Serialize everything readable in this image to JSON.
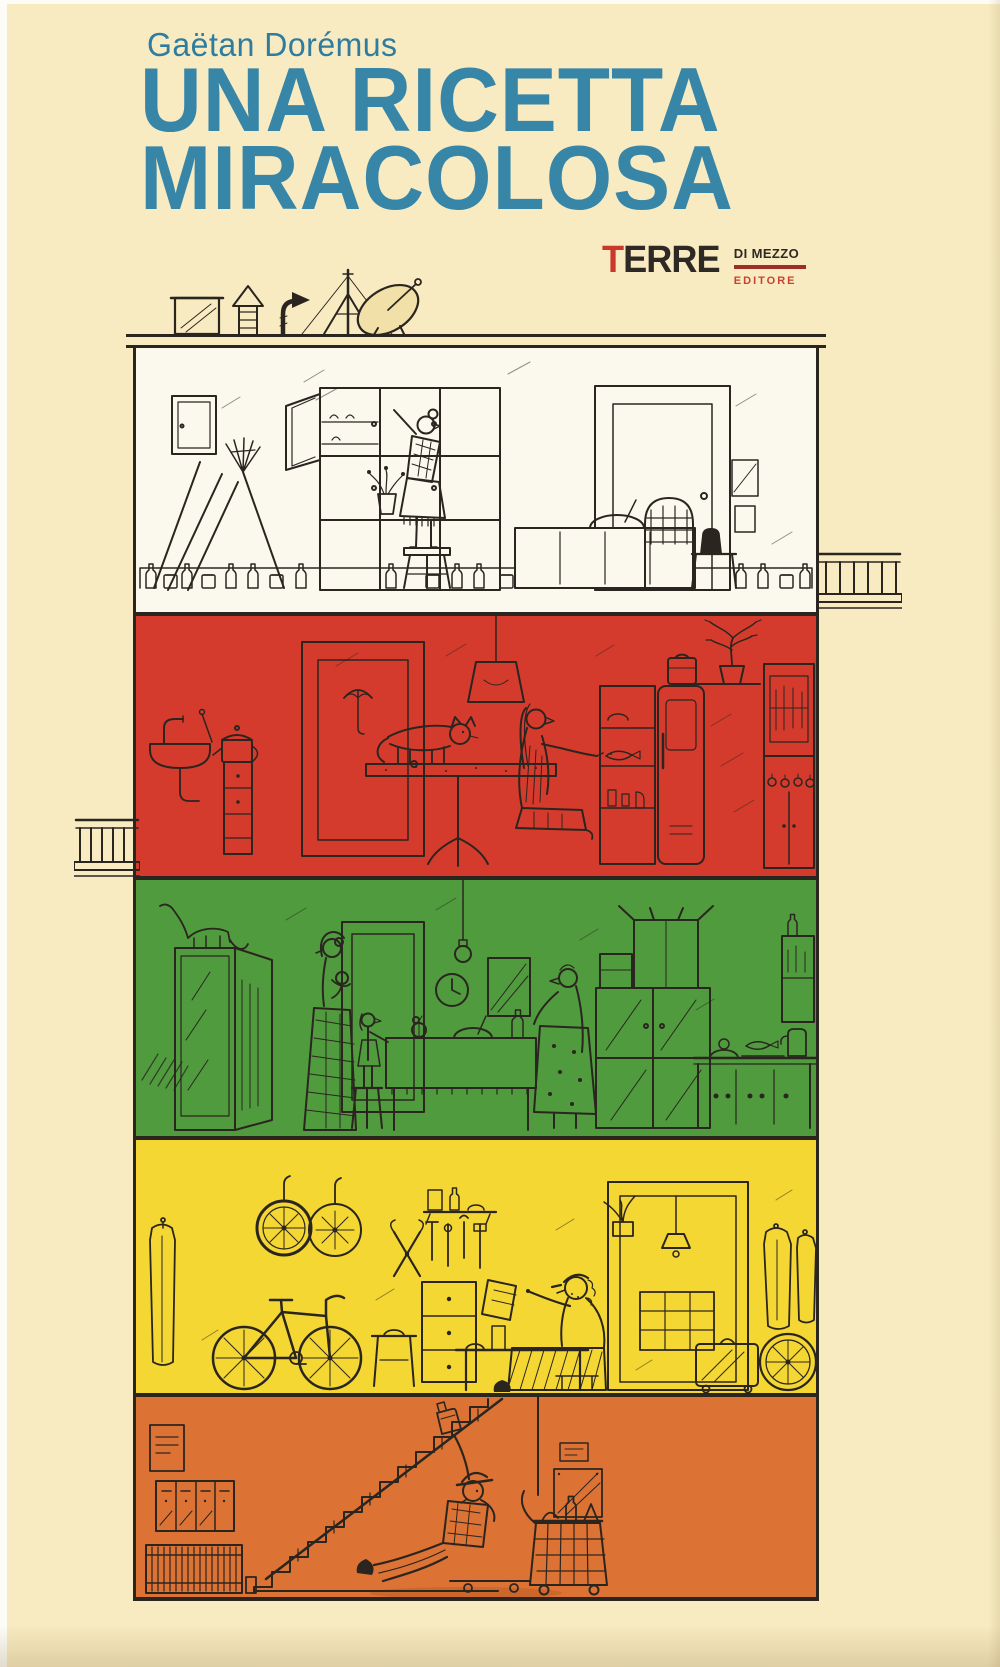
{
  "cover": {
    "author": "Gaëtan Dorémus",
    "title_line1": "UNA RICETTA",
    "title_line2": "MIRACOLOSA",
    "publisher": {
      "name": "TERRE",
      "imprint": "DI MEZZO",
      "descriptor": "EDITORE"
    },
    "colors": {
      "background_cream": "#f8ebc1",
      "title_blue": "#3786a8",
      "author_blue": "#2e7da0",
      "logo_black": "#2e2924",
      "logo_red": "#c9382b",
      "ink": "#2b2520",
      "floor_white": "#fbf8ee",
      "floor_red": "#d53b2d",
      "floor_green": "#4f9b3e",
      "floor_yellow": "#f4d733",
      "floor_orange": "#dc7233"
    },
    "building": {
      "floors": [
        {
          "name": "attic",
          "color": "#fbf8ee",
          "scene": "grandmother-on-stool-at-pantry-cupboard"
        },
        {
          "name": "fourth-floor",
          "color": "#d53b2d",
          "scene": "woman-kneeling-at-open-fridge-cat-on-table"
        },
        {
          "name": "third-floor",
          "color": "#4f9b3e",
          "scene": "family-laying-dinner-table-hanging-bulb"
        },
        {
          "name": "second-floor",
          "color": "#f4d733",
          "scene": "man-reading-in-bicycle-workshop"
        },
        {
          "name": "ground-floor",
          "color": "#dc7233",
          "scene": "fallen-shopper-by-staircase-basket-trolley"
        }
      ]
    }
  }
}
